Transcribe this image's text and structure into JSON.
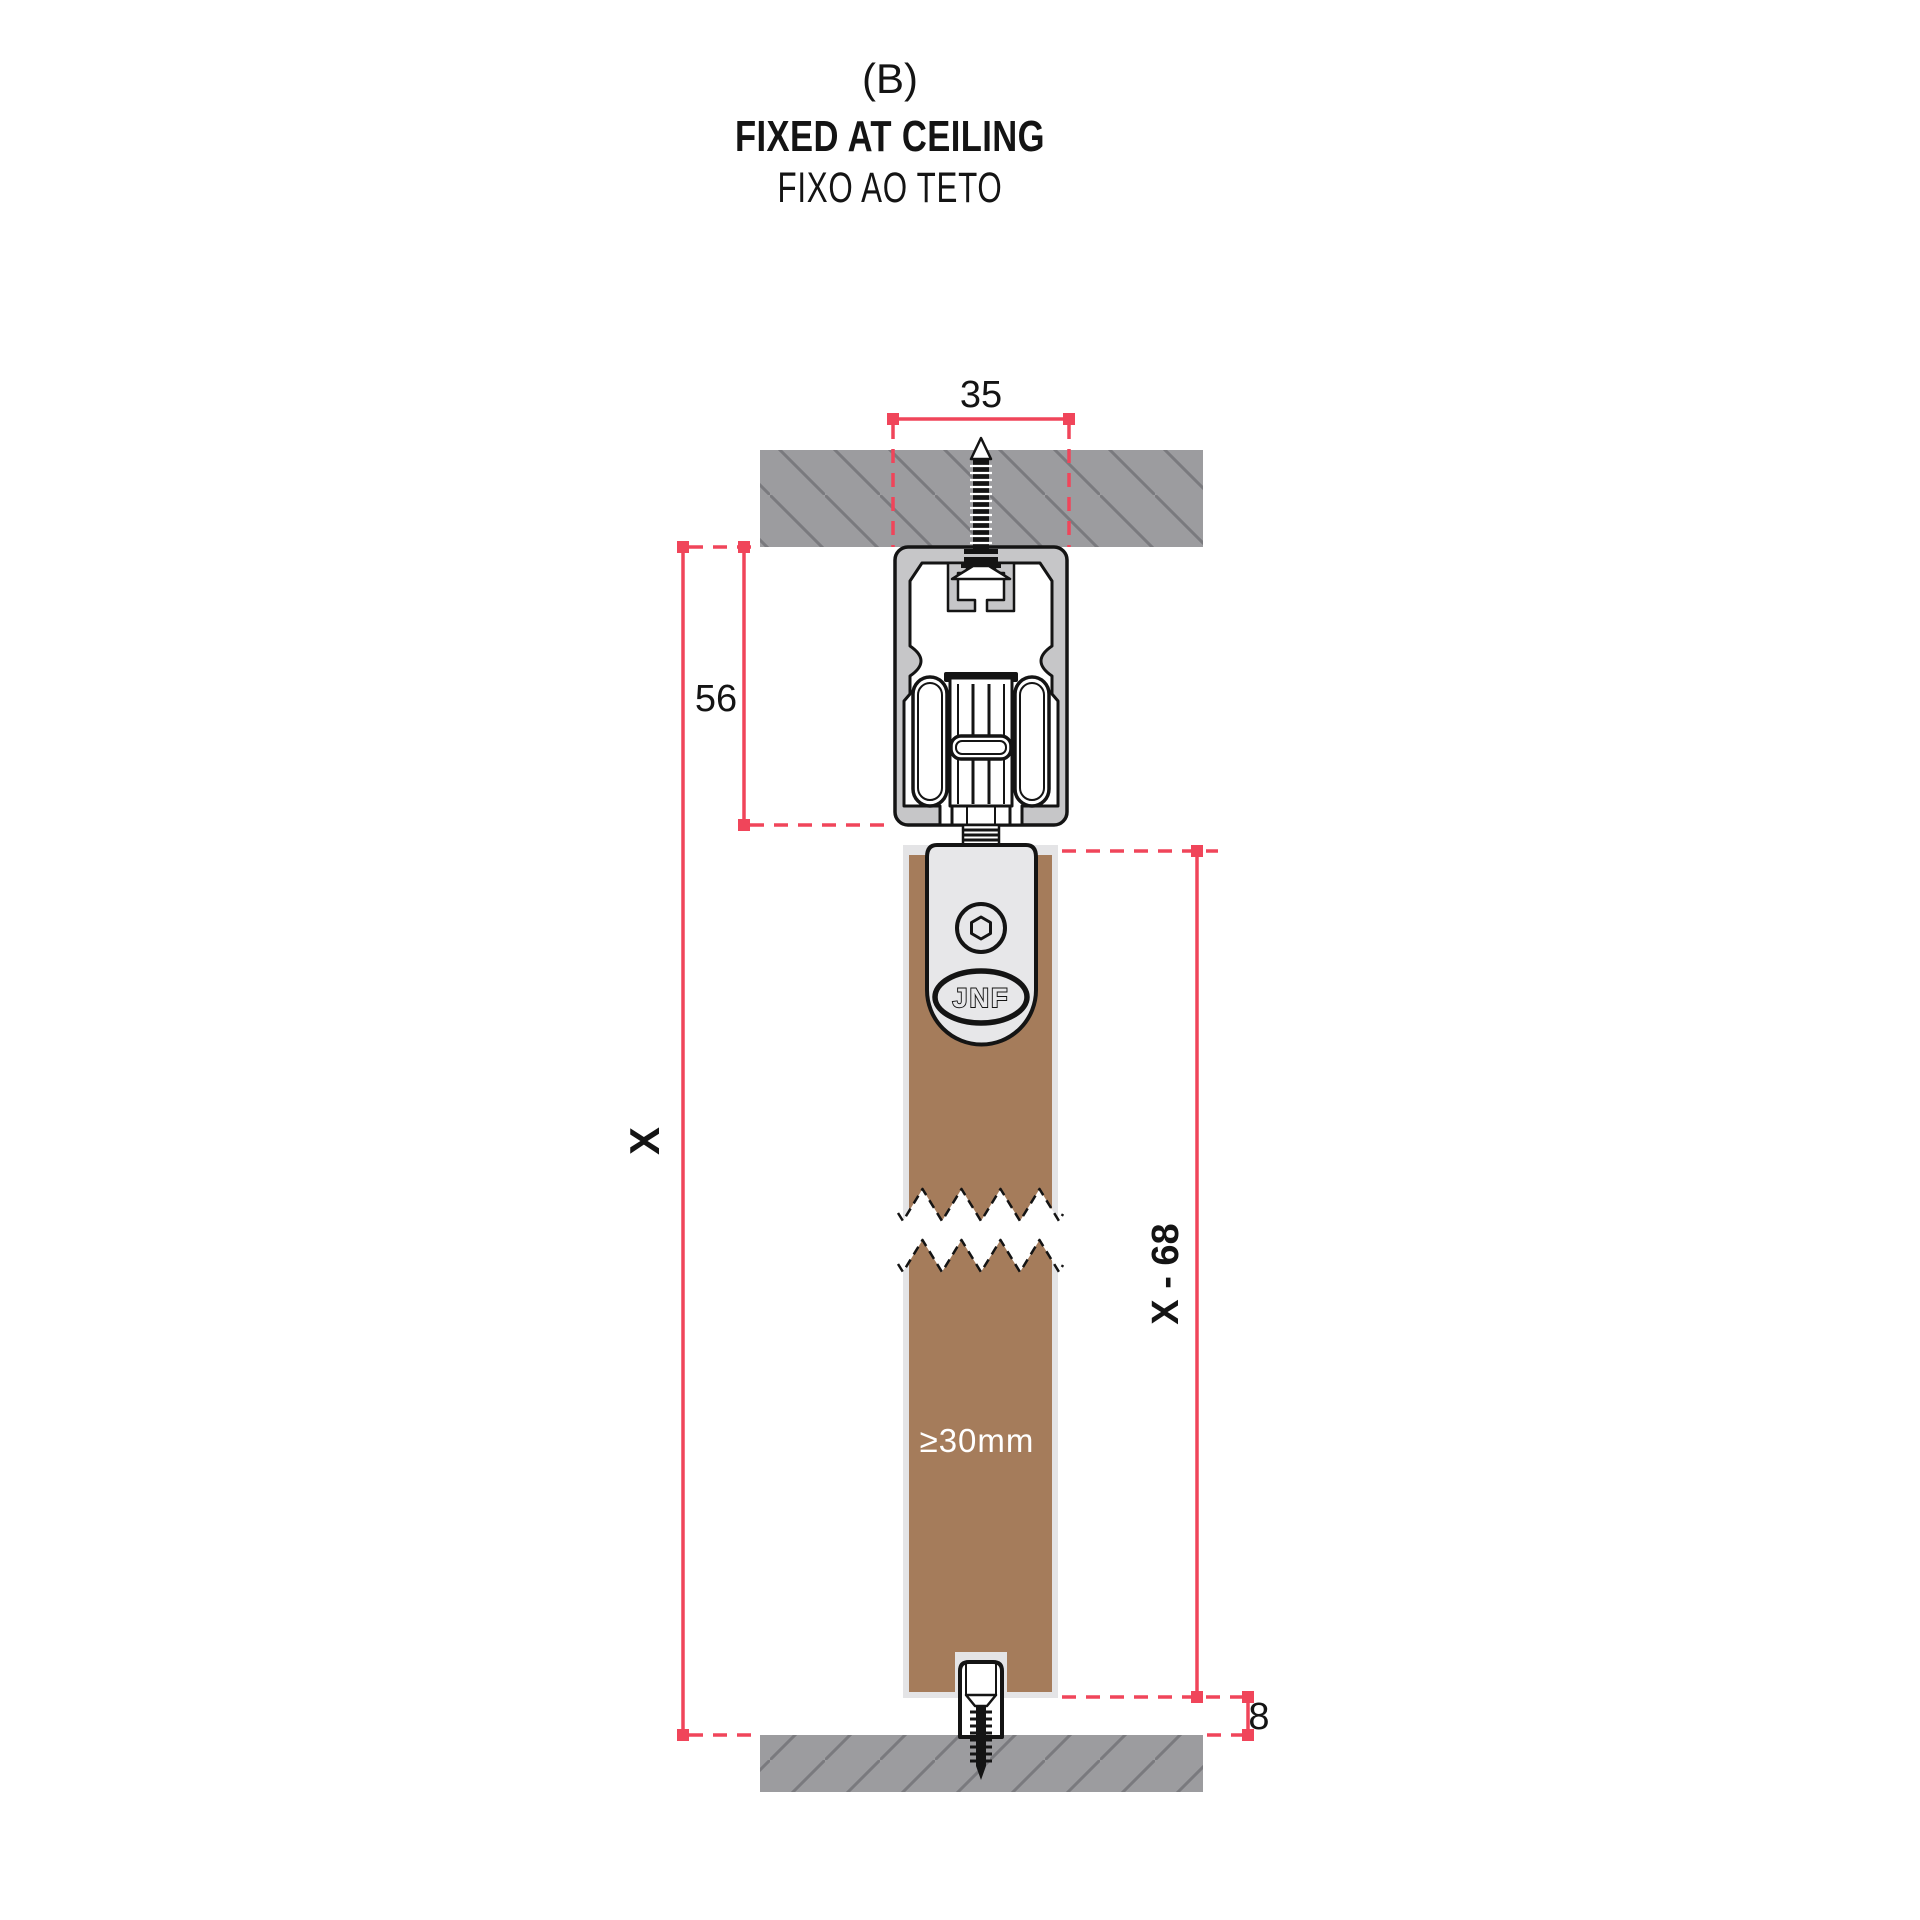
{
  "title": {
    "tag": "(B)",
    "heading": "FIXED AT CEILING",
    "subheading": "FIXO AO TETO"
  },
  "dimensions": {
    "track_width": "35",
    "track_assembly_height": "56",
    "total_height": "X",
    "door_height": "X - 68",
    "floor_clearance": "8"
  },
  "door": {
    "min_thickness": "≥30mm"
  },
  "logo": {
    "text": "JNF"
  },
  "colors": {
    "accent": "#F0455A",
    "ink": "#141414",
    "wall": "#9C9C9F",
    "hatch": "#7A7A7E",
    "profile": "#C6C6C8",
    "bracket": "#E7E7E9",
    "door-edge": "#E4E4E6",
    "door-brown": "#A57C5B",
    "paper": "#FFFFFF"
  }
}
